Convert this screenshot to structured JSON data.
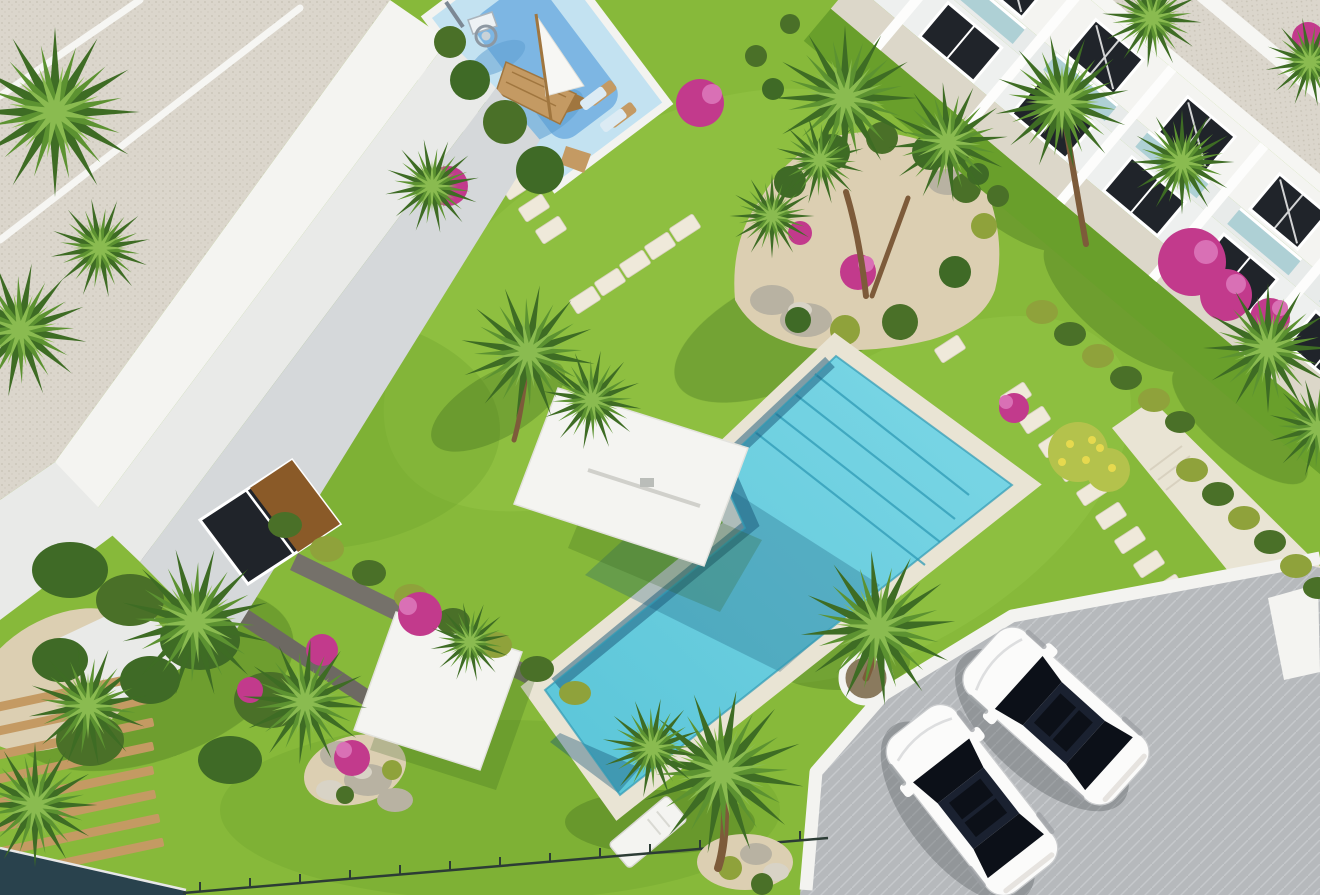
{
  "meta": {
    "alt": "Aerial 3D architectural rendering of a residential complex: communal turquoise swimming pool with corner steps, white shade canopies, kids playground with wooden boat and basketball hoop, lawns with palm trees and stepping-stone paths, white terraced-roof buildings, row of townhouses, and a parking pad with two white cars",
    "view": "aerial-render",
    "scene_type": "residential-resort-complex"
  },
  "inventory": {
    "pools": 1,
    "playgrounds": 1,
    "shade_canopies": 2,
    "parked_cars": 2,
    "townhouse_units_visible": 5,
    "stepping_stone_paths": 4,
    "palm_trees_approx": 24,
    "pink_flower_bushes_approx": 12
  },
  "colors": {
    "grass": "#87b93a",
    "grassLight": "#97c84a",
    "grassDark": "#699f2b",
    "shadow": "#2f5c17",
    "gravel": "#dbd6cc",
    "gravelDot": "#c7c1b4",
    "ridge": "#f6f6f3",
    "wallWhite": "#f4f4f1",
    "wallLight": "#e9eae8",
    "wallShade": "#d5d8da",
    "wallDark": "#c1c6c9",
    "window": "#20242a",
    "windowBrown": "#8a5a28",
    "frame": "#ffffff",
    "deck": "#e9e4d4",
    "stone": "#efe9da",
    "stoneEdge": "#d8d1bf",
    "poolLight": "#7cd7e6",
    "pool": "#5ac5d8",
    "poolShadow": "#175577",
    "poolEdge": "#2f9ab5",
    "playLight": "#c3e2f1",
    "playMid": "#7db6e3",
    "playShadow": "#5b9cd0",
    "sand": "#dccfb2",
    "rock": "#b8b2a2",
    "rockLight": "#d8d3c6",
    "wood": "#c49a63",
    "woodDark": "#a0763f",
    "trunk": "#7d5b3a",
    "palmDark": "#3e6c24",
    "palmMid": "#5c9231",
    "palmLight": "#8abb50",
    "bushDark": "#3f6a26",
    "hedge": "#8fa23b",
    "conifer": "#4a7028",
    "pink": "#c23a8c",
    "pinkLight": "#d970b5",
    "yellowBush": "#b4c24c",
    "yellowDot": "#e6d94e",
    "parking": "#b6b9bc",
    "parkingLine": "#c6c9cc",
    "curb": "#f3f3f0",
    "carBody": "#fbfbfa",
    "carGlass": "#1a2130",
    "carGlass2": "#0c1018",
    "fence": "#2c3c35",
    "glassPanel": "#29424d"
  }
}
